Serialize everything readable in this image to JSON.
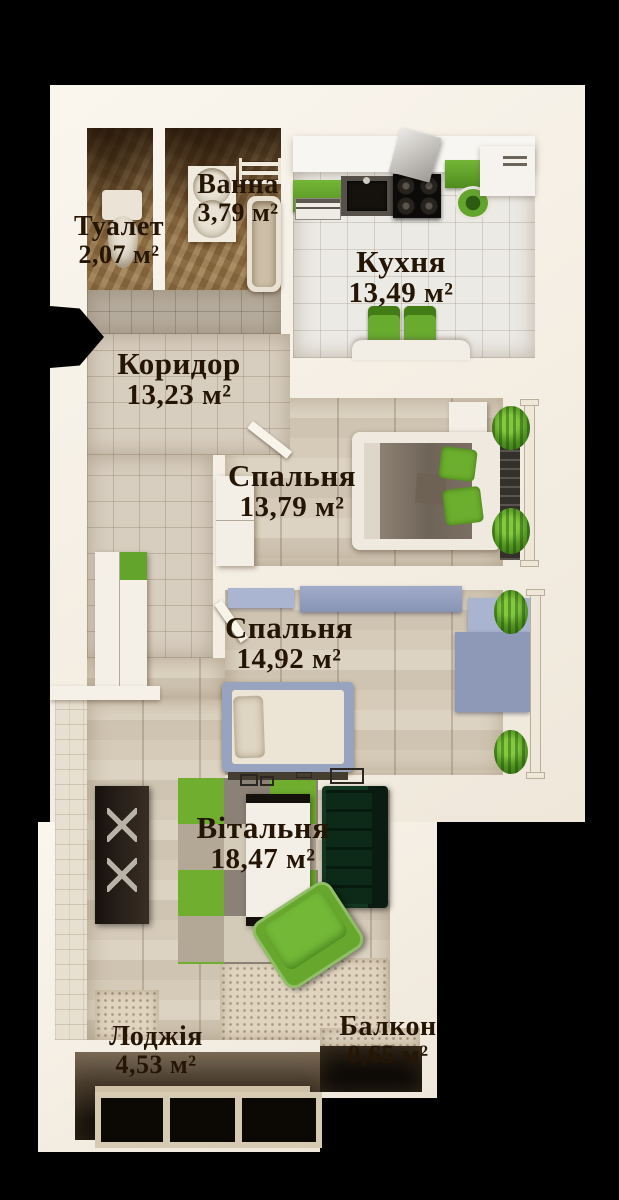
{
  "scene": {
    "type": "apartment-floor-plan-3d-top-view",
    "background_color": "#000000",
    "wall_color": "#f5f0e7",
    "label_color": "#241505",
    "accent_green": "#68a82c",
    "furniture_blue_grey": "#9aa5c2",
    "sofa_dark_green": "#0e2b1a",
    "bathroom_marble_brown": "#96764c"
  },
  "rooms": [
    {
      "id": "toilet",
      "name": "Туалет",
      "area": "2,07 м²"
    },
    {
      "id": "bath",
      "name": "Ванна",
      "area": "3,79 м²"
    },
    {
      "id": "kitchen",
      "name": "Кухня",
      "area": "13,49 м²"
    },
    {
      "id": "corridor",
      "name": "Коридор",
      "area": "13,23 м²"
    },
    {
      "id": "bedroom-1",
      "name": "Спальня",
      "area": "13,79 м²"
    },
    {
      "id": "bedroom-2",
      "name": "Спальня",
      "area": "14,92 м²"
    },
    {
      "id": "living-room",
      "name": "Вітальня",
      "area": "18,47 м²"
    },
    {
      "id": "loggia",
      "name": "Лоджія",
      "area": "4,53 м²"
    },
    {
      "id": "balcony",
      "name": "Балкон",
      "area": "0,65 м²"
    }
  ]
}
